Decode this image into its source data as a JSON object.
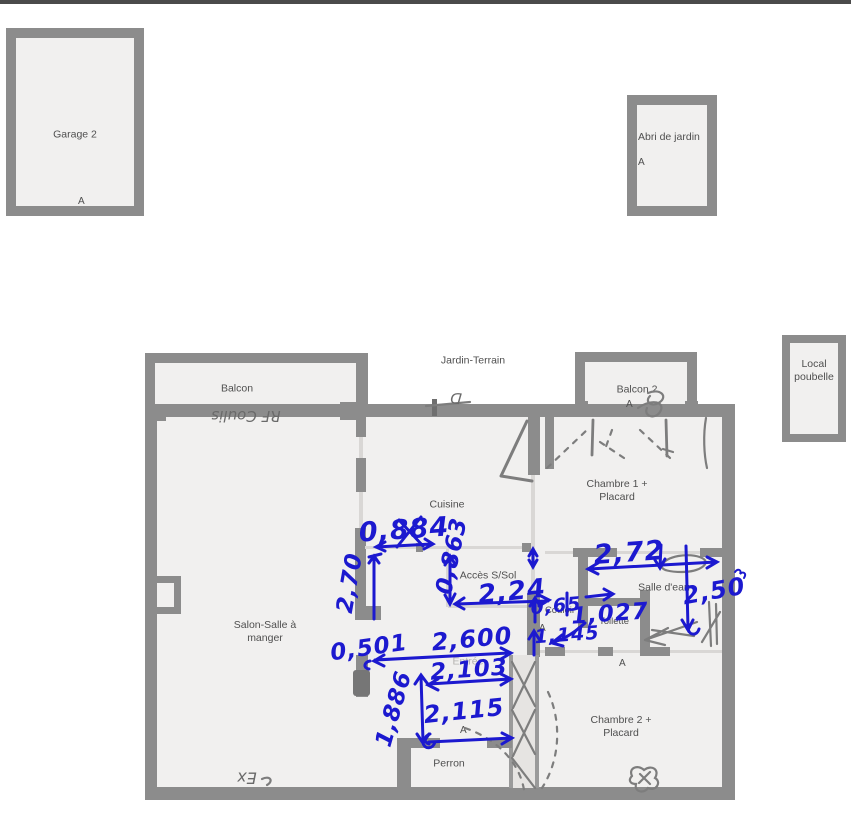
{
  "palette": {
    "wall": "#8c8c8c",
    "room": "#f1f0ef",
    "thin": "#d9d7d5",
    "label": "#4f4f4f",
    "blue": "#1c19cf",
    "pencil": "#7d7d7d"
  },
  "outbuildings": {
    "garage": {
      "label": "Garage 2",
      "door": "A"
    },
    "abri": {
      "label": "Abri de jardin",
      "door": "A"
    },
    "local": {
      "line1": "Local",
      "line2": "poubelle"
    }
  },
  "site": {
    "jardin": "Jardin-Terrain"
  },
  "rooms": {
    "balcon": "Balcon",
    "balcon2": "Balcon 2",
    "balcon2_door": "A",
    "cuisine": "Cuisine",
    "acces": "Accès S/Sol",
    "salon_line1": "Salon-Salle à",
    "salon_line2": "manger",
    "salle_eau": "Salle d'eau",
    "couloir": "Couloir",
    "toilette": "Toilette",
    "chambre1_line1": "Chambre 1 +",
    "chambre1_line2": "Placard",
    "chambre2_line1": "Chambre 2 +",
    "chambre2_line2": "Placard",
    "perron": "Perron",
    "entree": "Entrée",
    "door_a_couloir": "A",
    "door_a_chambre2": "A",
    "door_a_perron": "A"
  },
  "measurements": {
    "m_0884": "0,884",
    "m_0863": "0,863",
    "m_224": "2,24",
    "m_270": "2,70",
    "m_272": "2,72",
    "m_250": "2,50",
    "m_065": "0,65",
    "m_1027": "1,027",
    "m_1145": "1,145",
    "m_0501": "0,501",
    "m_2600": "2,600",
    "m_2103": "2,103",
    "m_1886": "1,886",
    "m_2115": "2,115"
  },
  "pencil_notes": {
    "balcony": "RF Coulis",
    "bottom": "Ex",
    "jardin_door": "D"
  }
}
